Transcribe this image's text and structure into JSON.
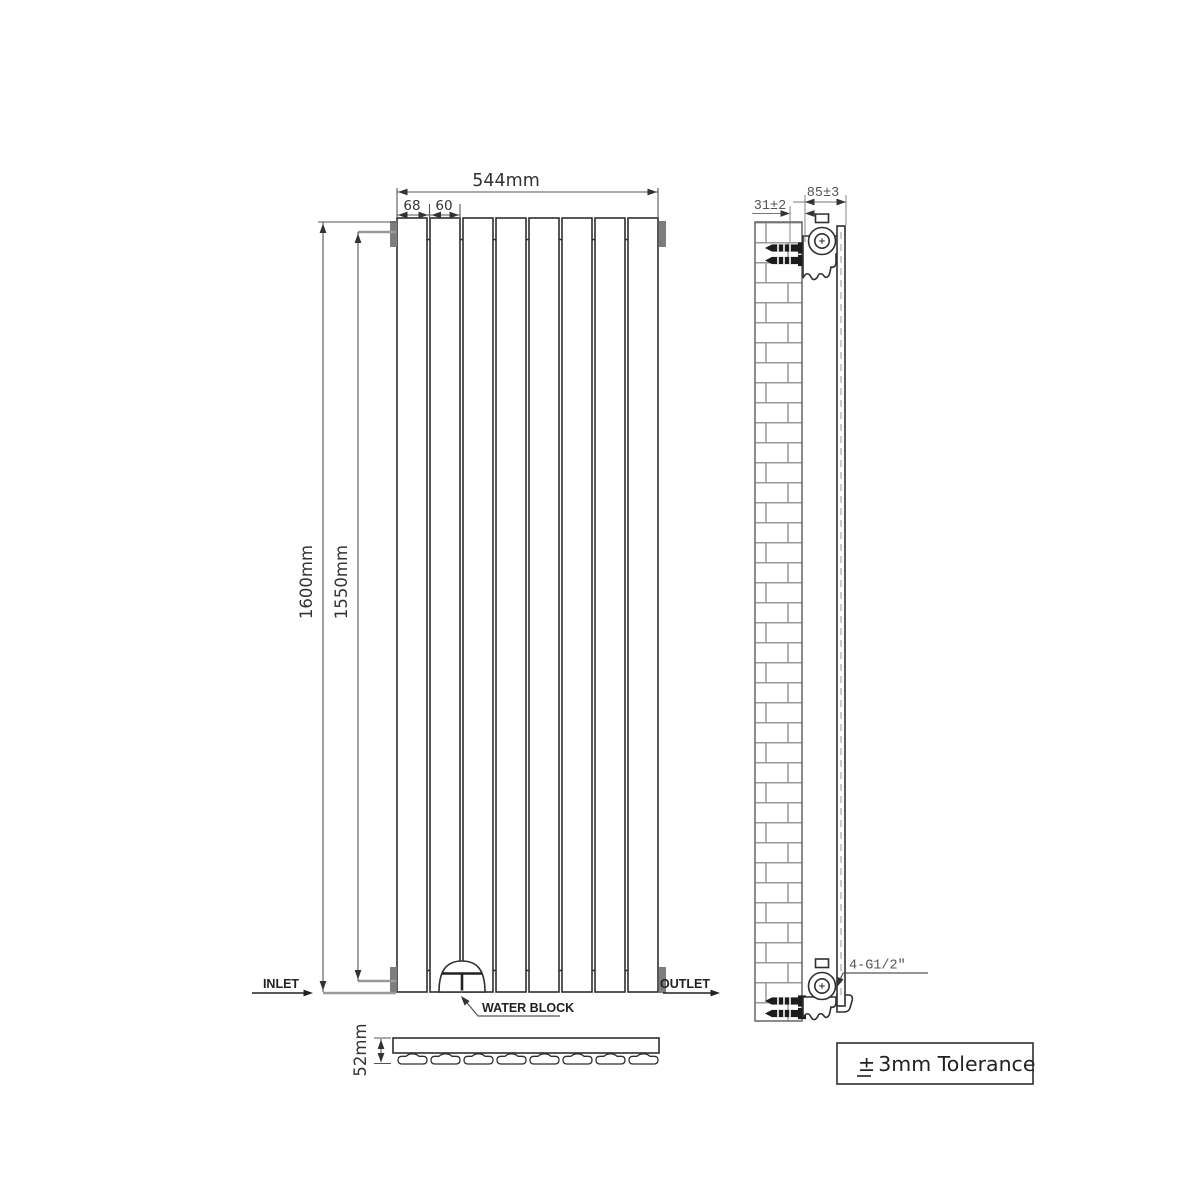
{
  "front_view": {
    "panel_count": 8,
    "width_label": "544mm",
    "pitch_label": "68",
    "panel_width_label": "60",
    "height_label": "1600mm",
    "inner_height_label": "1550mm",
    "inlet_label": "INLET",
    "outlet_label": "OUTLET",
    "water_block_label": "WATER BLOCK"
  },
  "bottom_view": {
    "tube_count": 8,
    "depth_label": "52mm"
  },
  "side_view": {
    "wall_fixing_depth_label": "31±2",
    "wall_distance_label": "85±3",
    "connection_label": "4-G1/2\""
  },
  "tolerance": {
    "symbol": "±",
    "text": "3mm Tolerance"
  },
  "colors": {
    "line": "#2f2f2f",
    "dim": "#555555",
    "gray": "#999999",
    "tab": "#7d7d7d"
  }
}
